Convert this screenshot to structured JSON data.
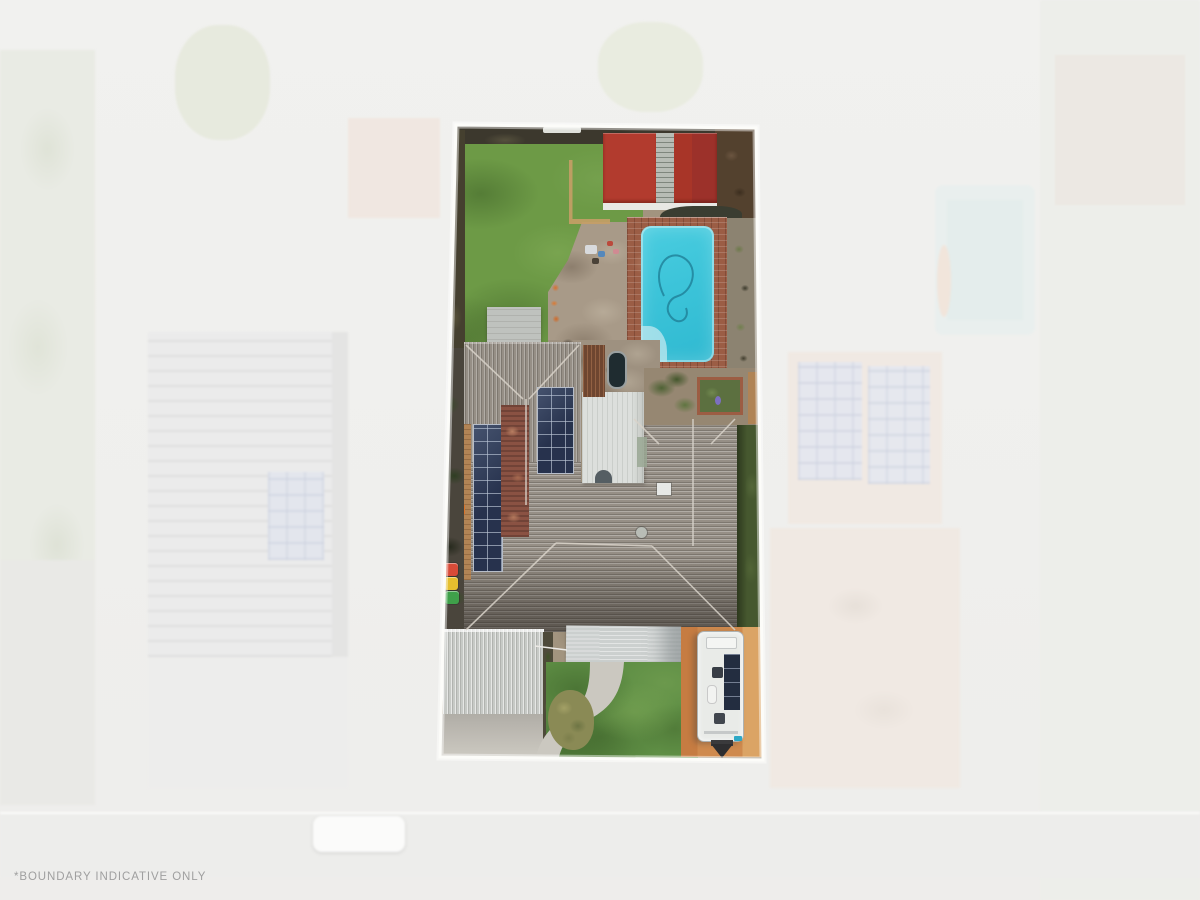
{
  "image": {
    "kind": "aerial-drone-photo",
    "subject": "top-down aerial view of a residential property; lot shown in full colour, surroundings faded white"
  },
  "disclaimer": {
    "text": "*BOUNDARY INDICATIVE ONLY"
  },
  "colors": {
    "background_wash": "#f0f0ee",
    "boundary_line": "#fcfcf9",
    "back_lawn_green": "#6d9a46",
    "front_lawn_green": "#5f8f45",
    "pool_water_cyan": "#3cc4d9",
    "pool_paving_brick": "#9b5d45",
    "shed_roof_red": "#b23b2e",
    "house_roof_grey": "#968f86",
    "solar_panel_navy": "#27324d",
    "terracotta_section": "#8a5243",
    "patio_roof_white": "#dcdfdc",
    "carport_grey": "#c7cac6",
    "awning_grey": "#ccd0cf",
    "caravan_body_white": "#e9ebe8",
    "caravan_pad_orange": "#c67c42",
    "deck_brown": "#6e4630",
    "bin_red": "#d84b38",
    "bin_yellow": "#e5bf2e",
    "bin_green": "#3fa04a",
    "disclaimer_text_grey": "#9f9f9f"
  },
  "features": {
    "visible": [
      "back-lawn",
      "red-shed",
      "shed-skylight",
      "swimming-pool",
      "pool-hose",
      "pool-paving",
      "patio-area",
      "outdoor-furniture",
      "wood-deck",
      "spa",
      "garden-shed-pad",
      "main-house-roof",
      "patio-roof",
      "solar-array-left",
      "solar-array-upper",
      "terracotta-roof-section",
      "wheelie-bins",
      "side-passage",
      "garage-roof",
      "driveway",
      "carport-awning",
      "front-lawn",
      "garden-path",
      "garden-shrub",
      "caravan",
      "caravan-solar-panels",
      "caravan-hitch",
      "caravan-pad",
      "planter-box",
      "boundary-line",
      "neighbour-pool",
      "neighbour-roofs",
      "road",
      "parked-car"
    ]
  }
}
